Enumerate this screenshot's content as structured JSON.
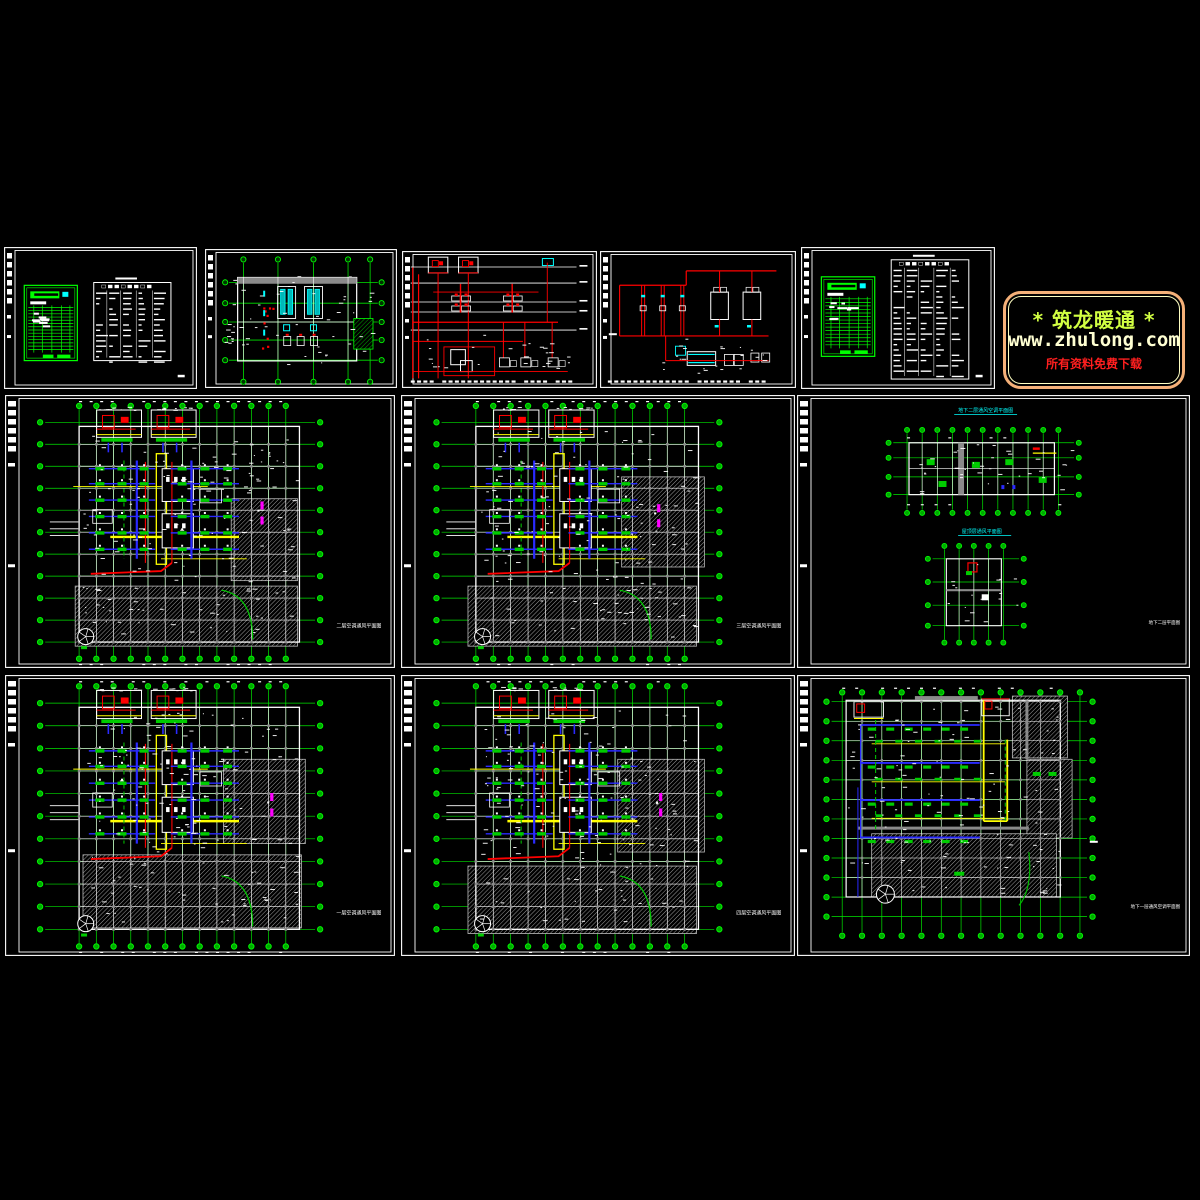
{
  "watermark": {
    "line1": "* 筑龙暖通 *",
    "line2": "www.zhulong.com",
    "line3": "所有资料免费下载",
    "border_outer": "#f4b078",
    "border_inner": "#ffffc2",
    "line1_color": "#d2ff42",
    "line2_color": "#ffffd2",
    "line3_color": "#ff1f1f"
  },
  "palette": {
    "green": "#00e500",
    "bright_green": "#00ff00",
    "cyan": "#00ffff",
    "red": "#ff0000",
    "yellow": "#ffff00",
    "blue": "#2a2aff",
    "magenta": "#ff00ff",
    "white": "#ffffff",
    "gray_wall": "#8a8a8a",
    "hatch": "#c4c4c4",
    "frame": "#ffffff"
  },
  "panels": {
    "sheet_legend_a": {
      "x": 4,
      "y": 247,
      "w": 193,
      "h": 142,
      "kind": "legend_sheet",
      "seed": 11,
      "variant2": false
    },
    "sheet_machine": {
      "x": 205,
      "y": 249,
      "w": 192,
      "h": 139,
      "kind": "machine_plan",
      "seed": 21
    },
    "sheet_schematic": {
      "x": 402,
      "y": 251,
      "w": 195,
      "h": 137,
      "kind": "schematic",
      "seed": 31
    },
    "sheet_flow": {
      "x": 600,
      "y": 251,
      "w": 196,
      "h": 137,
      "kind": "flow_diagram",
      "seed": 41
    },
    "sheet_legend_b": {
      "x": 801,
      "y": 247,
      "w": 194,
      "h": 142,
      "kind": "legend_sheet",
      "seed": 51,
      "variant2": true
    },
    "plan_2f": {
      "x": 5,
      "y": 395,
      "w": 390,
      "h": 273,
      "kind": "floor_plan",
      "seed": 61,
      "title": "二层空调通风平面图",
      "hatches": [
        [
          0.58,
          0.38,
          0.17,
          0.3
        ],
        [
          0.18,
          0.7,
          0.57,
          0.22
        ]
      ],
      "magenta": [
        0.655,
        0.39
      ]
    },
    "plan_3f": {
      "x": 401,
      "y": 395,
      "w": 394,
      "h": 273,
      "kind": "floor_plan",
      "seed": 71,
      "title": "三层空调通风平面图",
      "hatches": [
        [
          0.56,
          0.3,
          0.21,
          0.33
        ],
        [
          0.17,
          0.7,
          0.58,
          0.22
        ]
      ],
      "magenta": [
        0.65,
        0.4
      ]
    },
    "panel_duo": {
      "x": 797,
      "y": 395,
      "w": 393,
      "h": 273,
      "kind": "duo_plan",
      "seed": 81,
      "title_top": "地下二层通风空调平面图",
      "title_bottom": "屋顶层通风平面图",
      "title_corner": "地下二层平面图"
    },
    "plan_1f": {
      "x": 5,
      "y": 675,
      "w": 390,
      "h": 281,
      "kind": "floor_plan",
      "seed": 91,
      "title": "一层空调通风平面图",
      "hatches": [
        [
          0.56,
          0.3,
          0.21,
          0.3
        ],
        [
          0.2,
          0.64,
          0.56,
          0.26
        ]
      ],
      "magenta": [
        0.68,
        0.42
      ]
    },
    "plan_4f": {
      "x": 401,
      "y": 675,
      "w": 394,
      "h": 281,
      "kind": "floor_plan",
      "seed": 101,
      "title": "四层空调通风平面图",
      "hatches": [
        [
          0.55,
          0.3,
          0.22,
          0.33
        ],
        [
          0.17,
          0.68,
          0.58,
          0.24
        ]
      ],
      "magenta": [
        0.655,
        0.42
      ]
    },
    "plan_b1": {
      "x": 797,
      "y": 675,
      "w": 393,
      "h": 281,
      "kind": "wide_plan",
      "seed": 111,
      "title": "地下一层通风空调平面图"
    }
  }
}
